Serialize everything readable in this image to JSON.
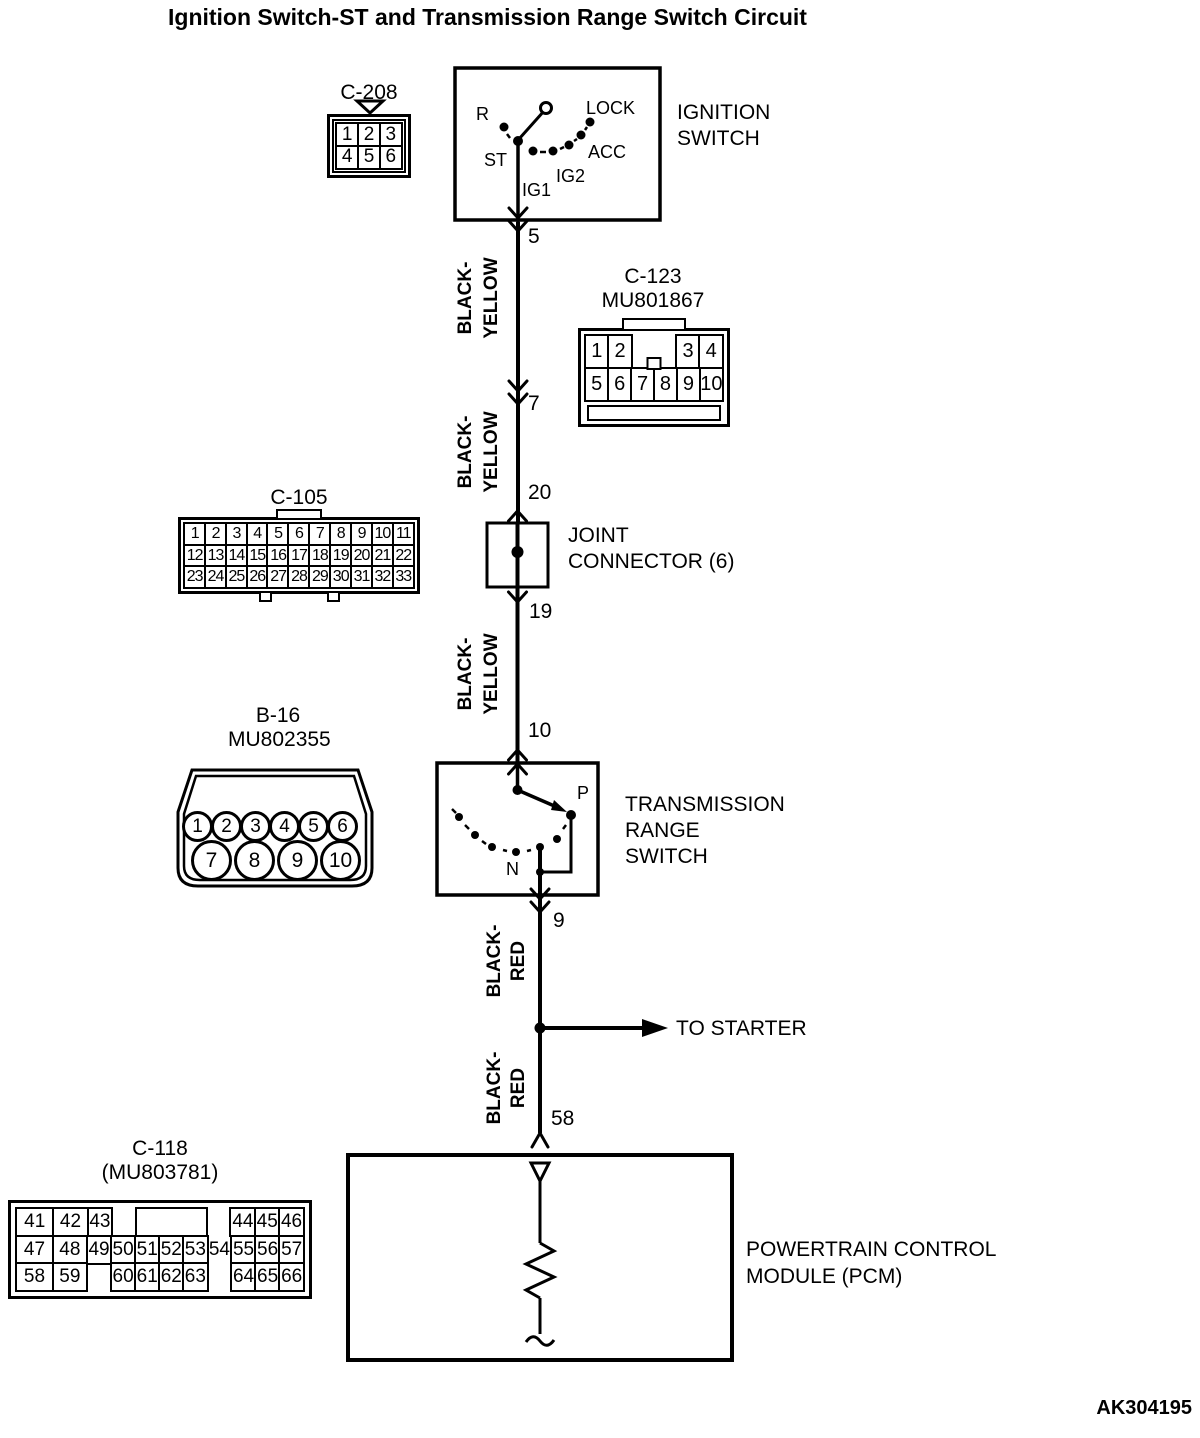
{
  "title": "Ignition Switch-ST and Transmission Range Switch Circuit",
  "diagram_code": "AK304195",
  "to_starter_label": "TO STARTER",
  "ignition_switch": {
    "name_line1": "IGNITION",
    "name_line2": "SWITCH",
    "positions": {
      "r": "R",
      "lock": "LOCK",
      "acc": "ACC",
      "ig2": "IG2",
      "ig1": "IG1",
      "st": "ST"
    }
  },
  "joint_connector": {
    "name_line1": "JOINT",
    "name_line2": "CONNECTOR (6)"
  },
  "transmission_range_switch": {
    "name_line1": "TRANSMISSION",
    "name_line2": "RANGE",
    "name_line3": "SWITCH",
    "position_p": "P",
    "position_n": "N"
  },
  "pcm": {
    "name_line1": "POWERTRAIN CONTROL",
    "name_line2": "MODULE (PCM)"
  },
  "wire_colors": {
    "black_yellow": [
      "BLACK-",
      "YELLOW"
    ],
    "black_red": [
      "BLACK-",
      "RED"
    ]
  },
  "pins": {
    "ignition_st_out": "5",
    "c123": "7",
    "joint_in": "20",
    "joint_out": "19",
    "trs_in": "10",
    "trs_out": "9",
    "pcm_in": "58"
  },
  "connectors": {
    "c208": {
      "name": "C-208",
      "grid": [
        [
          "1",
          "2",
          "3"
        ],
        [
          "4",
          "5",
          "6"
        ]
      ]
    },
    "c123": {
      "name": "C-123",
      "part": "MU801867",
      "grid": [
        [
          {
            "t": "1"
          },
          {
            "t": "2"
          },
          {
            "t": "",
            "box": false,
            "w": 2
          },
          {
            "t": "3"
          },
          {
            "t": "4"
          }
        ],
        [
          "5",
          "6",
          "7",
          "8",
          "9",
          "10"
        ]
      ]
    },
    "c105": {
      "name": "C-105",
      "grid": [
        [
          "1",
          "2",
          "3",
          "4",
          "5",
          "6",
          "7",
          "8",
          "9",
          "10",
          "11"
        ],
        [
          "12",
          "13",
          "14",
          "15",
          "16",
          "17",
          "18",
          "19",
          "20",
          "21",
          "22"
        ],
        [
          "23",
          "24",
          "25",
          "26",
          "27",
          "28",
          "29",
          "30",
          "31",
          "32",
          "33"
        ]
      ]
    },
    "b16": {
      "name": "B-16",
      "part": "MU802355",
      "grid": [
        [
          "1",
          "2",
          "3",
          "4",
          "5",
          "6"
        ],
        [
          "7",
          "8",
          "9",
          "10"
        ]
      ]
    },
    "c118": {
      "name": "C-118",
      "part": "(MU803781)",
      "grid": [
        [
          {
            "t": "41",
            "w": 1.55
          },
          {
            "t": "42",
            "w": 1.45
          },
          {
            "t": "43"
          },
          {
            "t": "",
            "box": false
          },
          {
            "t": "",
            "w": 3
          },
          {
            "t": "",
            "box": false
          },
          {
            "t": "44"
          },
          {
            "t": "45"
          },
          {
            "t": "46"
          }
        ],
        [
          {
            "t": "47",
            "w": 1.55
          },
          {
            "t": "48",
            "w": 1.45
          },
          {
            "t": "49"
          },
          {
            "t": "50"
          },
          {
            "t": "51"
          },
          {
            "t": "52"
          },
          {
            "t": "53"
          },
          {
            "t": "54",
            "box": false
          },
          {
            "t": "55"
          },
          {
            "t": "56"
          },
          {
            "t": "57"
          }
        ],
        [
          {
            "t": "58",
            "w": 1.55
          },
          {
            "t": "59",
            "w": 1.45
          },
          {
            "t": "",
            "box": false
          },
          {
            "t": "60"
          },
          {
            "t": "61"
          },
          {
            "t": "62"
          },
          {
            "t": "63"
          },
          {
            "t": "",
            "box": false
          },
          {
            "t": "64"
          },
          {
            "t": "65"
          },
          {
            "t": "66"
          }
        ]
      ]
    }
  }
}
